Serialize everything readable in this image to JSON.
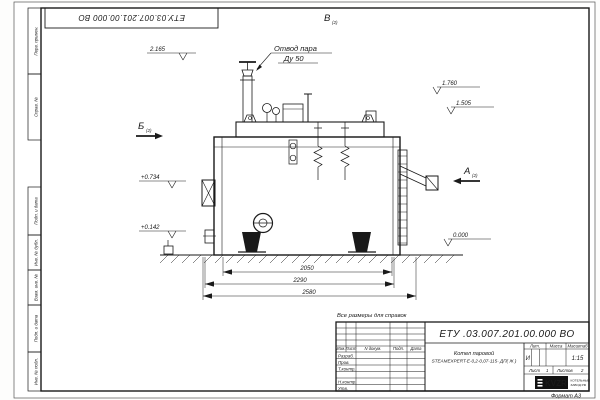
{
  "sheet": {
    "stamp_designation": "ЕТУ.03.007.201.00.000  ВО",
    "format_label": "Формат  А3",
    "note": "Все размеры для справок",
    "margin_top_labels": [
      "Перв. примен.",
      "Справ. №"
    ],
    "margin_bottom_labels": [
      "Подп. и дата",
      "Инв. № дубл.",
      "Взам. инв. №",
      "Подп. и дата",
      "Инв. № подл."
    ]
  },
  "drawing": {
    "callout": {
      "line1": "Отвод пара",
      "line2": "Ду 50"
    },
    "views": [
      {
        "letter": "Б",
        "sub": "(2)"
      },
      {
        "letter": "В",
        "sub": "(2)"
      },
      {
        "letter": "А",
        "sub": "(2)"
      }
    ],
    "elevations": [
      "2.165",
      "1.760",
      "1.505",
      "+0.734",
      "+0.142",
      "0.000"
    ],
    "dimensions": [
      "2050",
      "2290",
      "2580"
    ]
  },
  "title_block": {
    "designation": "ЕТУ .03.007.201.00.000  ВО",
    "product_name": "Котел паровой",
    "product_model": "STEAMEXPERT-Е-0,2-0,07-115- ДП( Ж )",
    "header_cells": [
      "Изм.",
      "Лист",
      "N докум.",
      "Подп.",
      "Дата"
    ],
    "staff_labels": [
      "Разраб.",
      "Пров.",
      "Т.контр.",
      "Н.контр.",
      "Утв."
    ],
    "lit_label": "Лит.",
    "lit_value": "И",
    "mass_label": "Масса",
    "scale_label": "Масштаб",
    "scale_value": "1:15",
    "sheet_label": "Лист",
    "sheet_number": "1",
    "sheets_label": "Листов",
    "sheets_total": "2",
    "logo_text": "KVZR",
    "company_line1": "КОТЕЛЬНЫЙ",
    "company_line2": "ЗАВОД РФ"
  }
}
